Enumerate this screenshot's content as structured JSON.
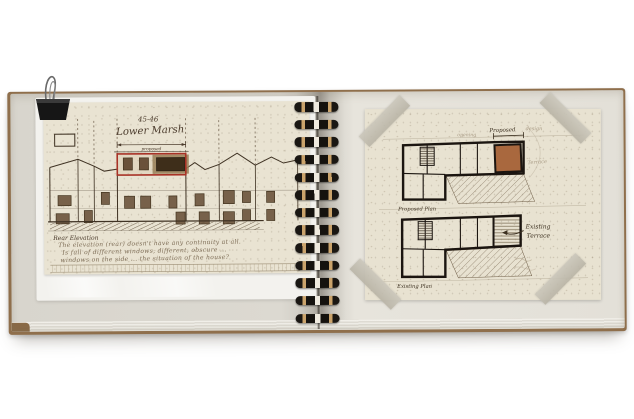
{
  "photo": {
    "description": "Open spiral-bound sketchbook with architectural sketches, held by a binder clip",
    "background_color": "#ffffff"
  },
  "book": {
    "cover_color": "#8f6f4c",
    "page_color_left": "#dcd9d1",
    "page_color_right": "#e3e0d8",
    "binding": {
      "loop_count": 13
    }
  },
  "left_page": {
    "sheet_color": "#e9e3d2",
    "accent_red": "#a83226",
    "title_small": "45-46",
    "title_main": "Lower Marsh",
    "proposed_label": "proposed",
    "caption": "Rear Elevation",
    "notes": {
      "l1": "The elevation (rear) doesn't have any continuity at all.",
      "l2": "Is full of different windows, different, obscure ...",
      "l3": "windows on the side ... the situation of the house?"
    }
  },
  "right_page": {
    "sheet_color": "#e8e2d1",
    "tape_color": "#c7c3b7",
    "plan_top": {
      "label": "Proposed",
      "label_faint": "design",
      "note_faint": "opening",
      "terrace_faint": "Terrace",
      "room_fill": "#a9683e",
      "caption": "Proposed Plan"
    },
    "plan_bottom": {
      "annotation1": "Existing",
      "annotation2": "Terrace",
      "caption": "Existing Plan"
    }
  }
}
